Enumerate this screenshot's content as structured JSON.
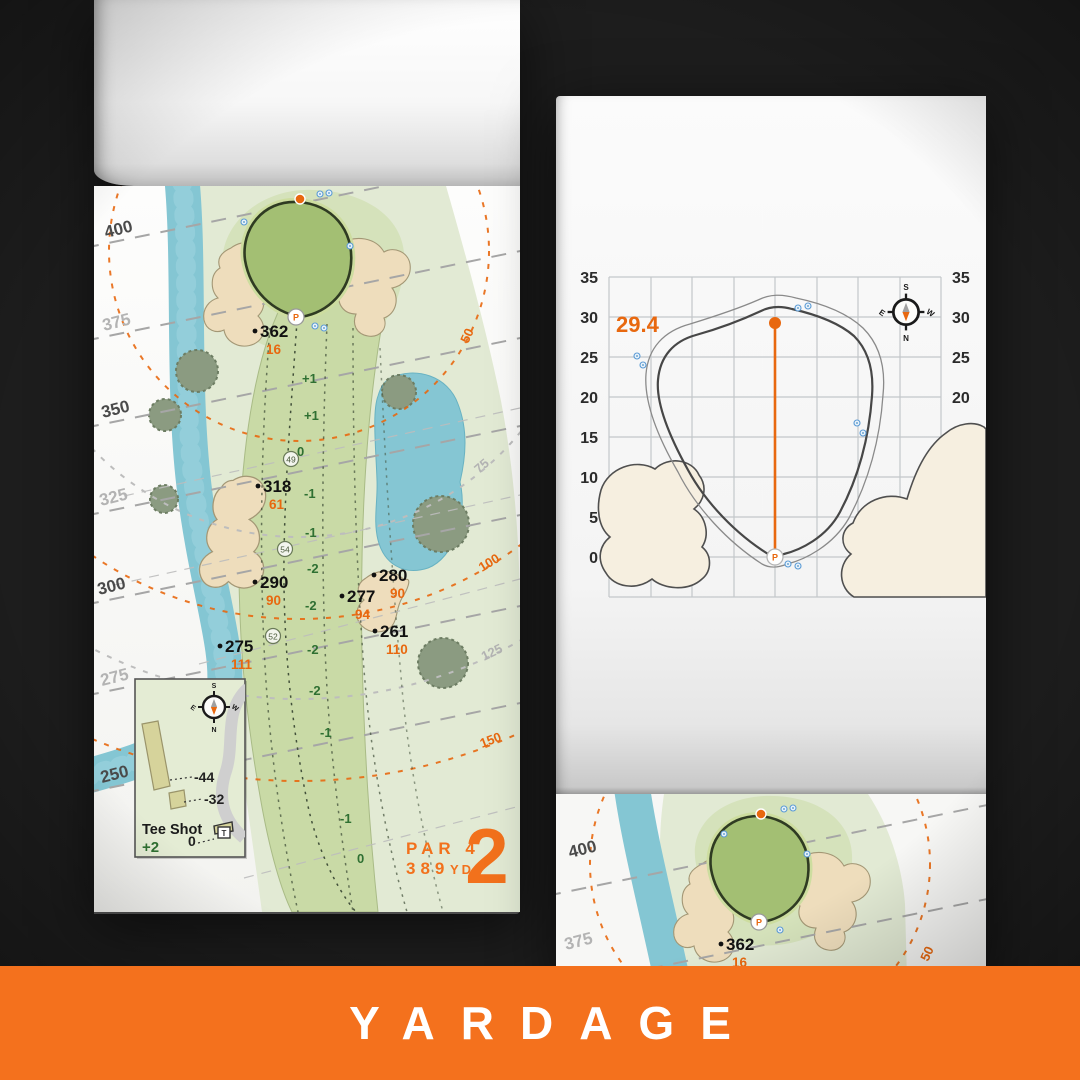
{
  "banner": {
    "label": "YARDAGE"
  },
  "colors": {
    "banner_orange": "#f4711d",
    "map_orange": "#e8680f",
    "dark_background": "#1d1d1d",
    "green_text": "#2f7032",
    "water_blue": "#85c6d3",
    "sand": "#eeddbc",
    "putting_green": "#a3bf73"
  },
  "left_page": {
    "distance_markers": [
      "400",
      "375",
      "350",
      "325",
      "300",
      "275",
      "250"
    ],
    "arc_labels": [
      "50",
      "75",
      "100",
      "125",
      "150"
    ],
    "yardages": [
      {
        "carry": "362",
        "front": "16"
      },
      {
        "carry": "318",
        "front": "61"
      },
      {
        "carry": "290",
        "front": "90"
      },
      {
        "carry": "275",
        "front": "111"
      },
      {
        "carry": "280",
        "front": "90"
      },
      {
        "carry": "277",
        "front": "94"
      },
      {
        "carry": "261",
        "front": "110"
      }
    ],
    "centerline": [
      "+1",
      "+1",
      "0",
      "-1",
      "-1",
      "-2",
      "-2",
      "-2",
      "-2",
      "-1",
      "-1",
      "0"
    ],
    "circled": [
      "49",
      "54",
      "52"
    ],
    "pin_letter": "P",
    "tee_inset": {
      "title": "Tee Shot",
      "score": "+2",
      "offset_long": "-44",
      "offset_short": "-32",
      "offset_zero": "0",
      "tee_marker": "T"
    },
    "par_label": "PAR 4",
    "distance_value": "389",
    "distance_unit": "YD",
    "hole_number": "2",
    "compass": {
      "top": "S",
      "right": "W",
      "bottom": "N",
      "left": "E"
    }
  },
  "green_page": {
    "pin_depth": "29.4",
    "axis": [
      "35",
      "30",
      "25",
      "20",
      "15",
      "10",
      "5",
      "0"
    ],
    "pin_letter": "P",
    "compass": {
      "top": "S",
      "right": "W",
      "bottom": "N",
      "left": "E"
    }
  },
  "next_page": {
    "distance_markers": [
      "400",
      "375"
    ],
    "yardage": {
      "carry": "362",
      "front": "16"
    },
    "arc_label": "50",
    "pin_letter": "P"
  }
}
